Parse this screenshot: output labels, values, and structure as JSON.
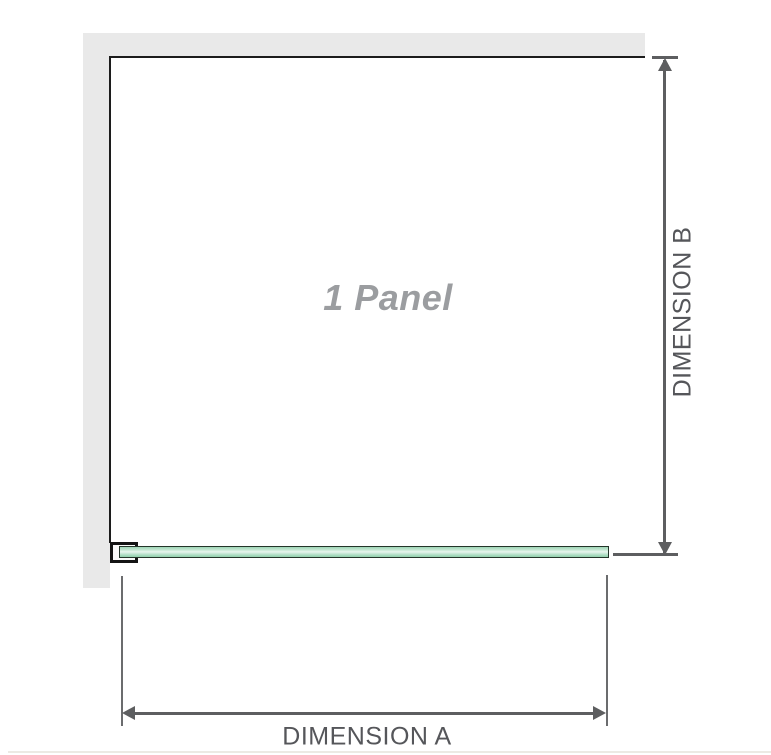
{
  "diagram": {
    "panel_label": "1 Panel",
    "dimension_a": {
      "label": "DIMENSION A"
    },
    "dimension_b": {
      "label": "DIMENSION B"
    },
    "colors": {
      "wall_fill": "#e9e9e9",
      "panel_outline": "#1c1c1c",
      "glass_fill": "#a9dcc0",
      "glass_highlight": "#e9f6ef",
      "glass_border": "#24352a",
      "bracket_outline": "#141414",
      "dimension_line": "#5d5e60",
      "extension_line": "#6b6c6e",
      "dimension_text": "#55565a",
      "panel_text": "#9b9da0"
    },
    "icons": [
      "arrow-up-icon",
      "arrow-down-icon",
      "arrow-left-icon",
      "arrow-right-icon"
    ]
  }
}
